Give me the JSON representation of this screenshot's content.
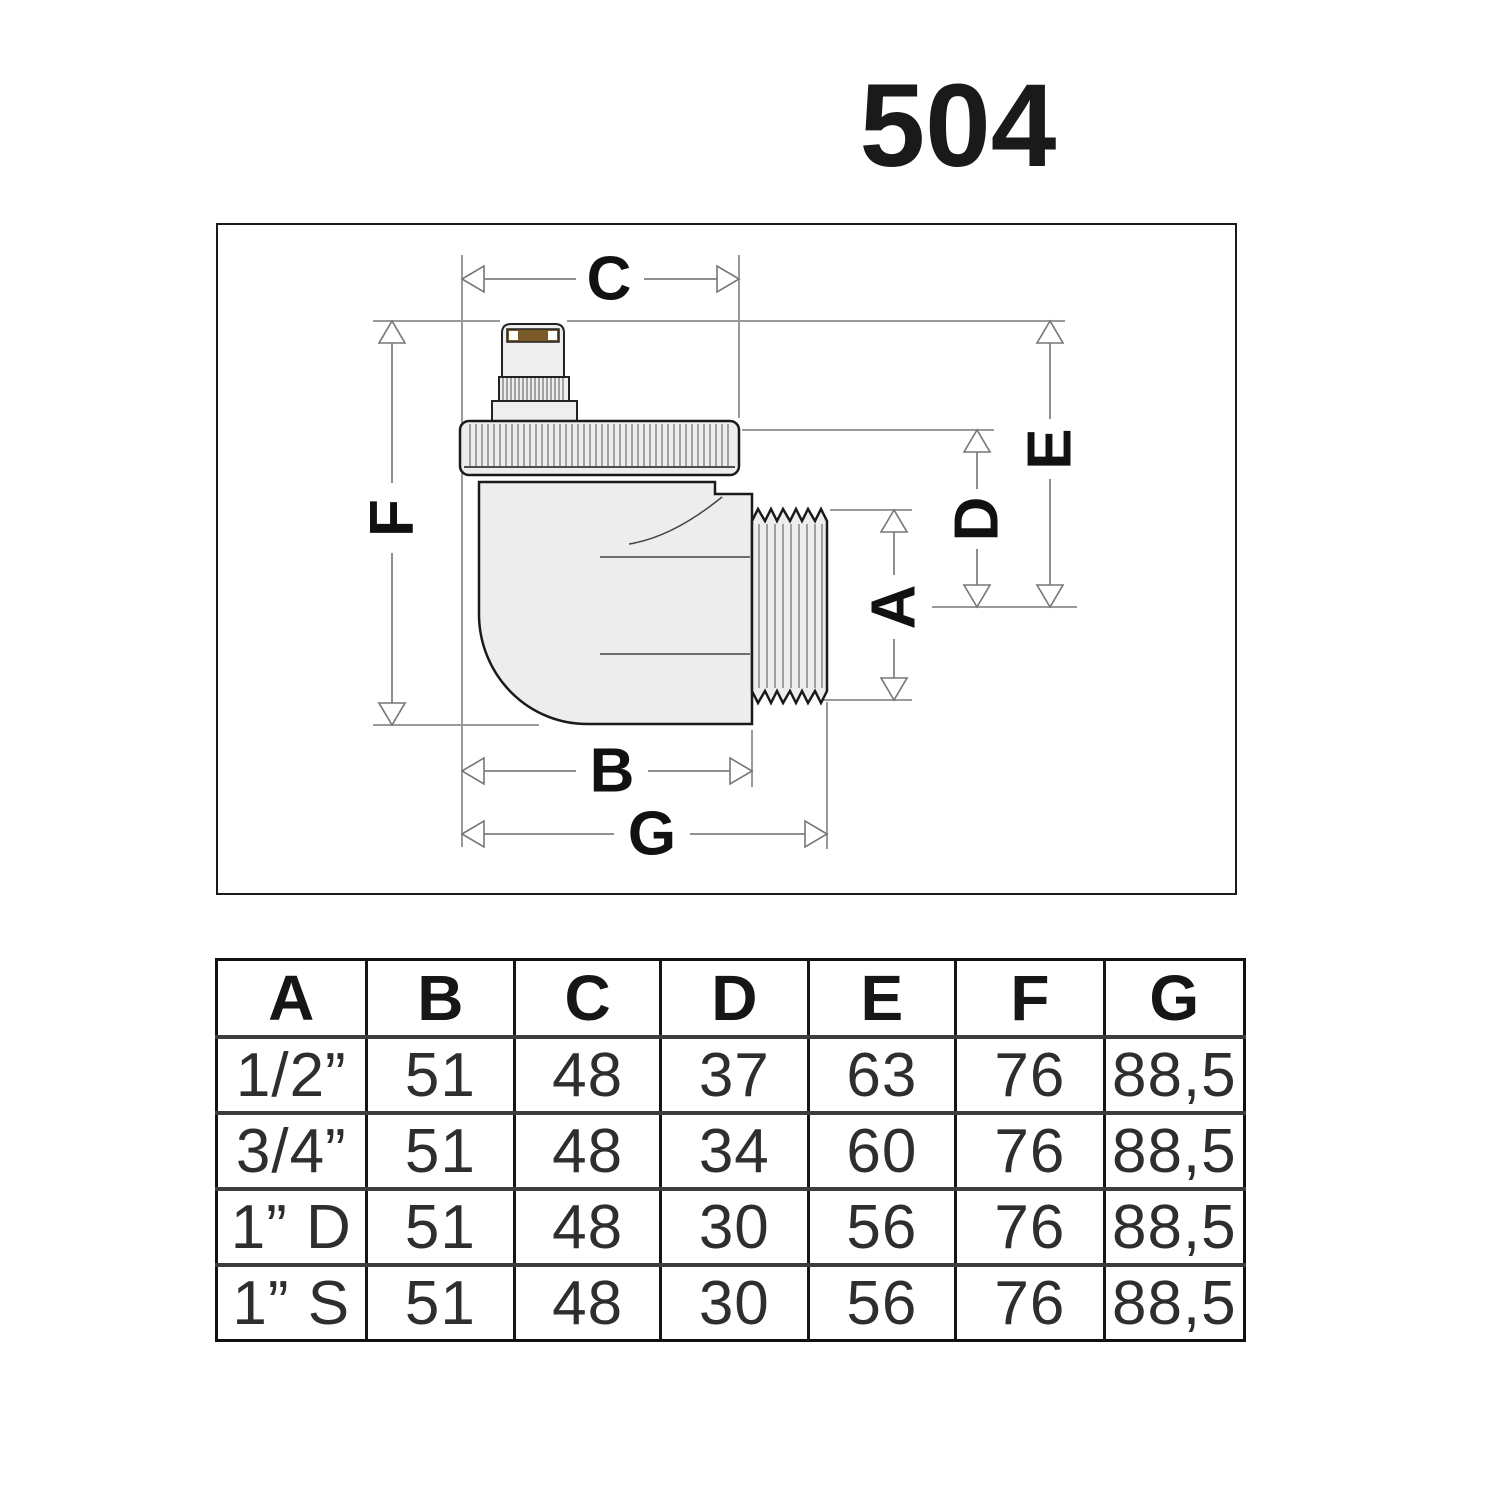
{
  "title": "504",
  "diagram": {
    "dim_labels": {
      "a": "A",
      "b": "B",
      "c": "C",
      "d": "D",
      "e": "E",
      "f": "F",
      "g": "G"
    }
  },
  "table": {
    "headers": [
      "A",
      "B",
      "C",
      "D",
      "E",
      "F",
      "G"
    ],
    "rows": [
      [
        "1/2”",
        "51",
        "48",
        "37",
        "63",
        "76",
        "88,5"
      ],
      [
        "3/4”",
        "51",
        "48",
        "34",
        "60",
        "76",
        "88,5"
      ],
      [
        "1” D",
        "51",
        "48",
        "30",
        "56",
        "76",
        "88,5"
      ],
      [
        "1” S",
        "51",
        "48",
        "30",
        "56",
        "76",
        "88,5"
      ]
    ]
  }
}
